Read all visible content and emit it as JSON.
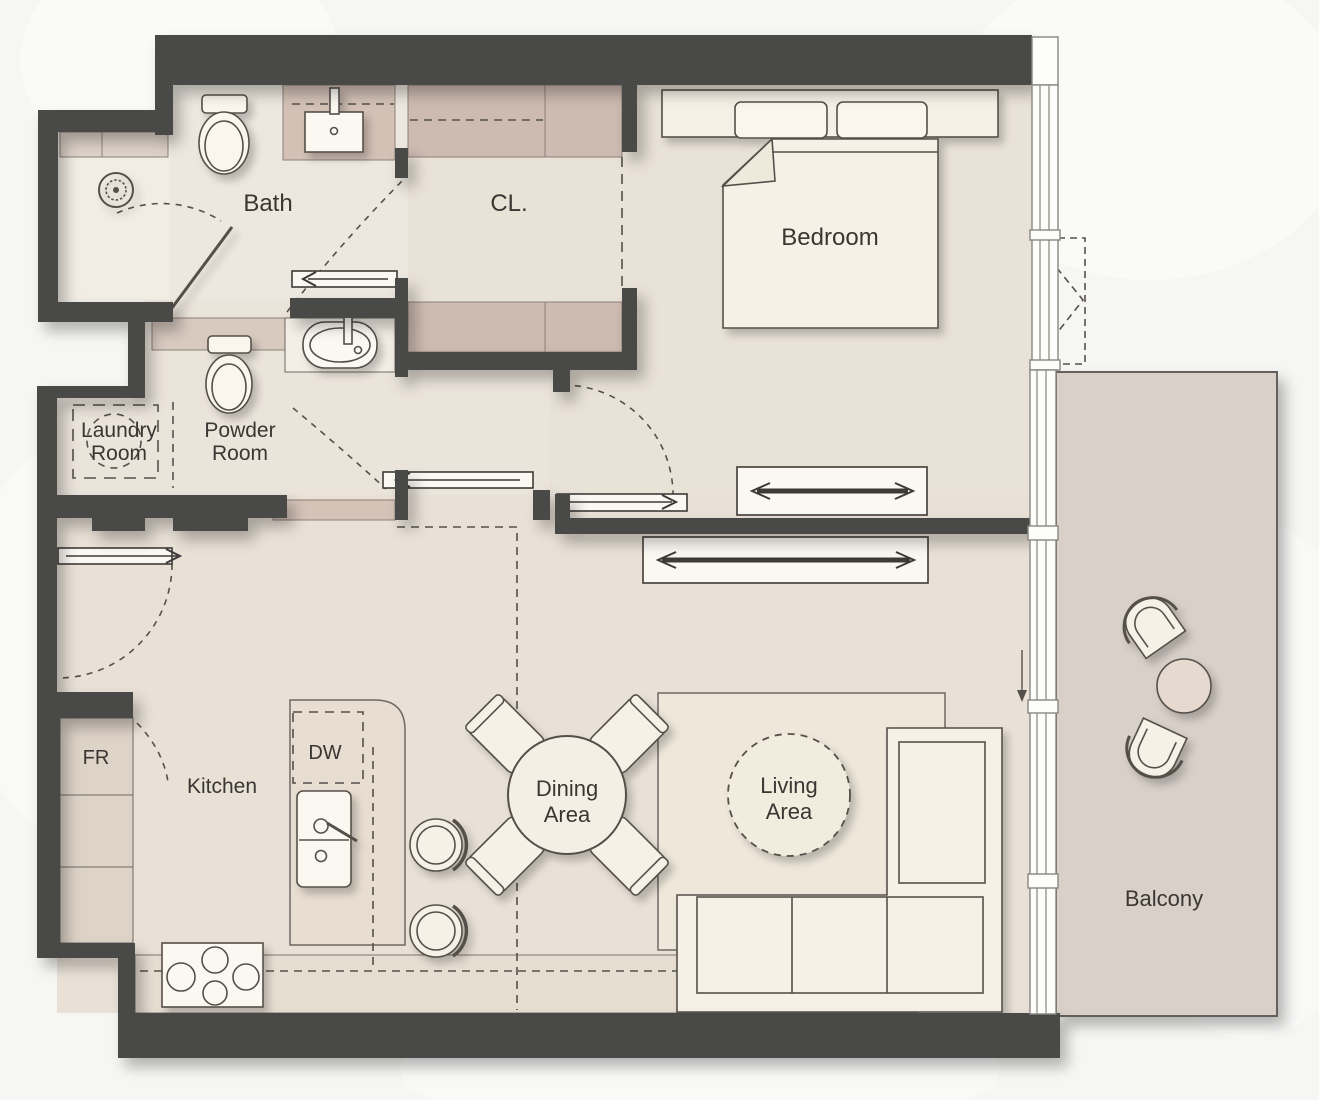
{
  "floorplan": {
    "title": "apartment-floor-plan",
    "rooms": {
      "bath": {
        "label": "Bath"
      },
      "closet": {
        "label": "CL."
      },
      "bedroom": {
        "label": "Bedroom"
      },
      "laundry": {
        "line1": "Laundry",
        "line2": "Room"
      },
      "powder": {
        "line1": "Powder",
        "line2": "Room"
      },
      "kitchen": {
        "label": "Kitchen"
      },
      "dining": {
        "line1": "Dining",
        "line2": "Area"
      },
      "living": {
        "line1": "Living",
        "line2": "Area"
      },
      "balcony": {
        "label": "Balcony"
      }
    },
    "appliances": {
      "fridge": {
        "label": "FR"
      },
      "dishwasher": {
        "label": "DW"
      }
    },
    "colors": {
      "wall": "#4a4846",
      "floor": "#e9e2d7",
      "floor_bath": "#ece7df",
      "cabinet_tan": "#cdbab0",
      "balcony_floor": "#d9d0c9",
      "furniture": "#f6f1e7",
      "line": "#55504a",
      "background": "#f7f7f5",
      "text": "#3a3632"
    }
  }
}
